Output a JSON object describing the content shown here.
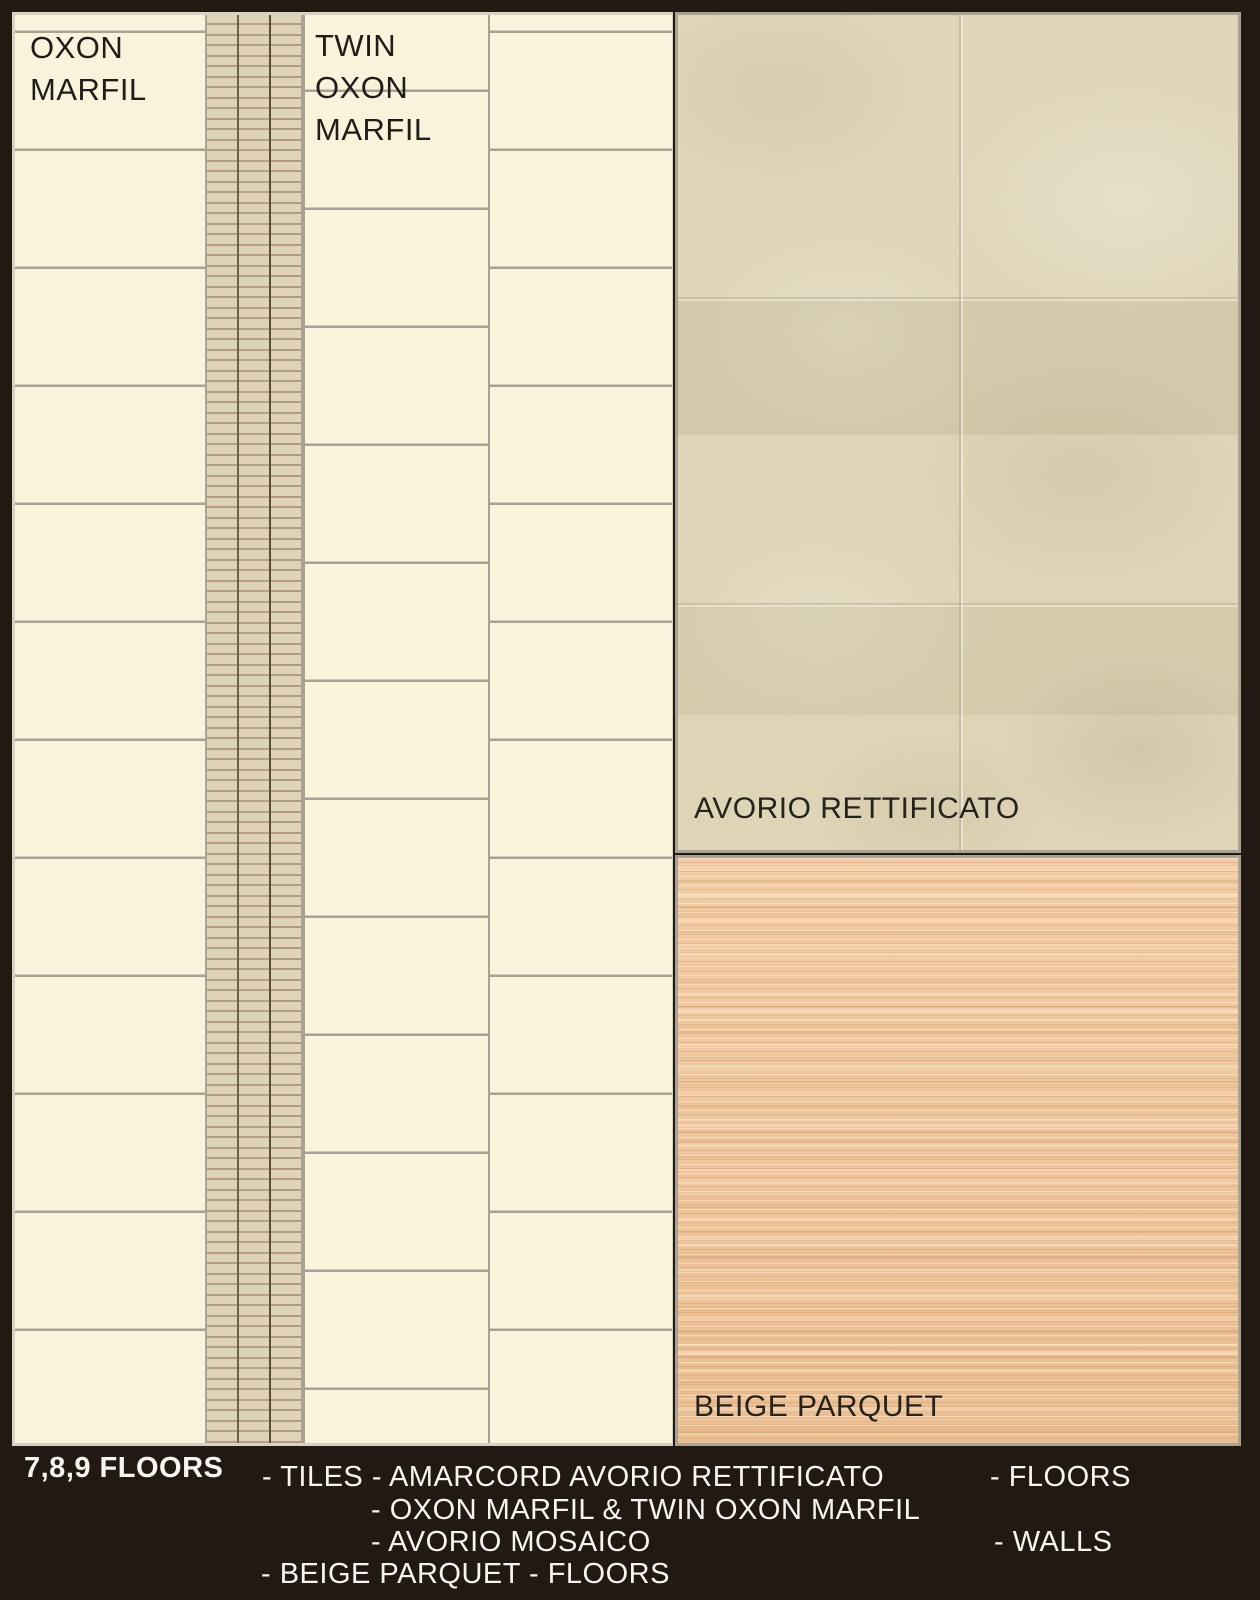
{
  "panels": {
    "oxon": {
      "label": "OXON\nMARFIL"
    },
    "twin": {
      "label": "TWIN\nOXON\nMARFIL"
    },
    "avorio": {
      "label": "AVORIO RETTIFICATO"
    },
    "parquet": {
      "label": "BEIGE PARQUET"
    }
  },
  "caption": {
    "floors_title": "7,8,9 FLOORS",
    "tiles_line": "- TILES - AMARCORD AVORIO RETTIFICATO",
    "floors_use": "- FLOORS",
    "line2": "- OXON MARFIL & TWIN OXON MARFIL",
    "line3": "- AVORIO MOSAICO",
    "walls_use": "- WALLS",
    "line4": "- BEIGE PARQUET - FLOORS"
  },
  "colors": {
    "background": "#221a12",
    "tile_cream": "#faf3dc",
    "grout_gray": "#a7a294",
    "mosaic_base": "#e3d9c1",
    "mosaic_grout": "#b09c7f",
    "avorio_base": "#dcd2b3",
    "parquet_base": "#eec39a",
    "label_dark": "#201d19",
    "caption_white": "#f7f5f1",
    "panel_border": "#d8d2c2"
  }
}
